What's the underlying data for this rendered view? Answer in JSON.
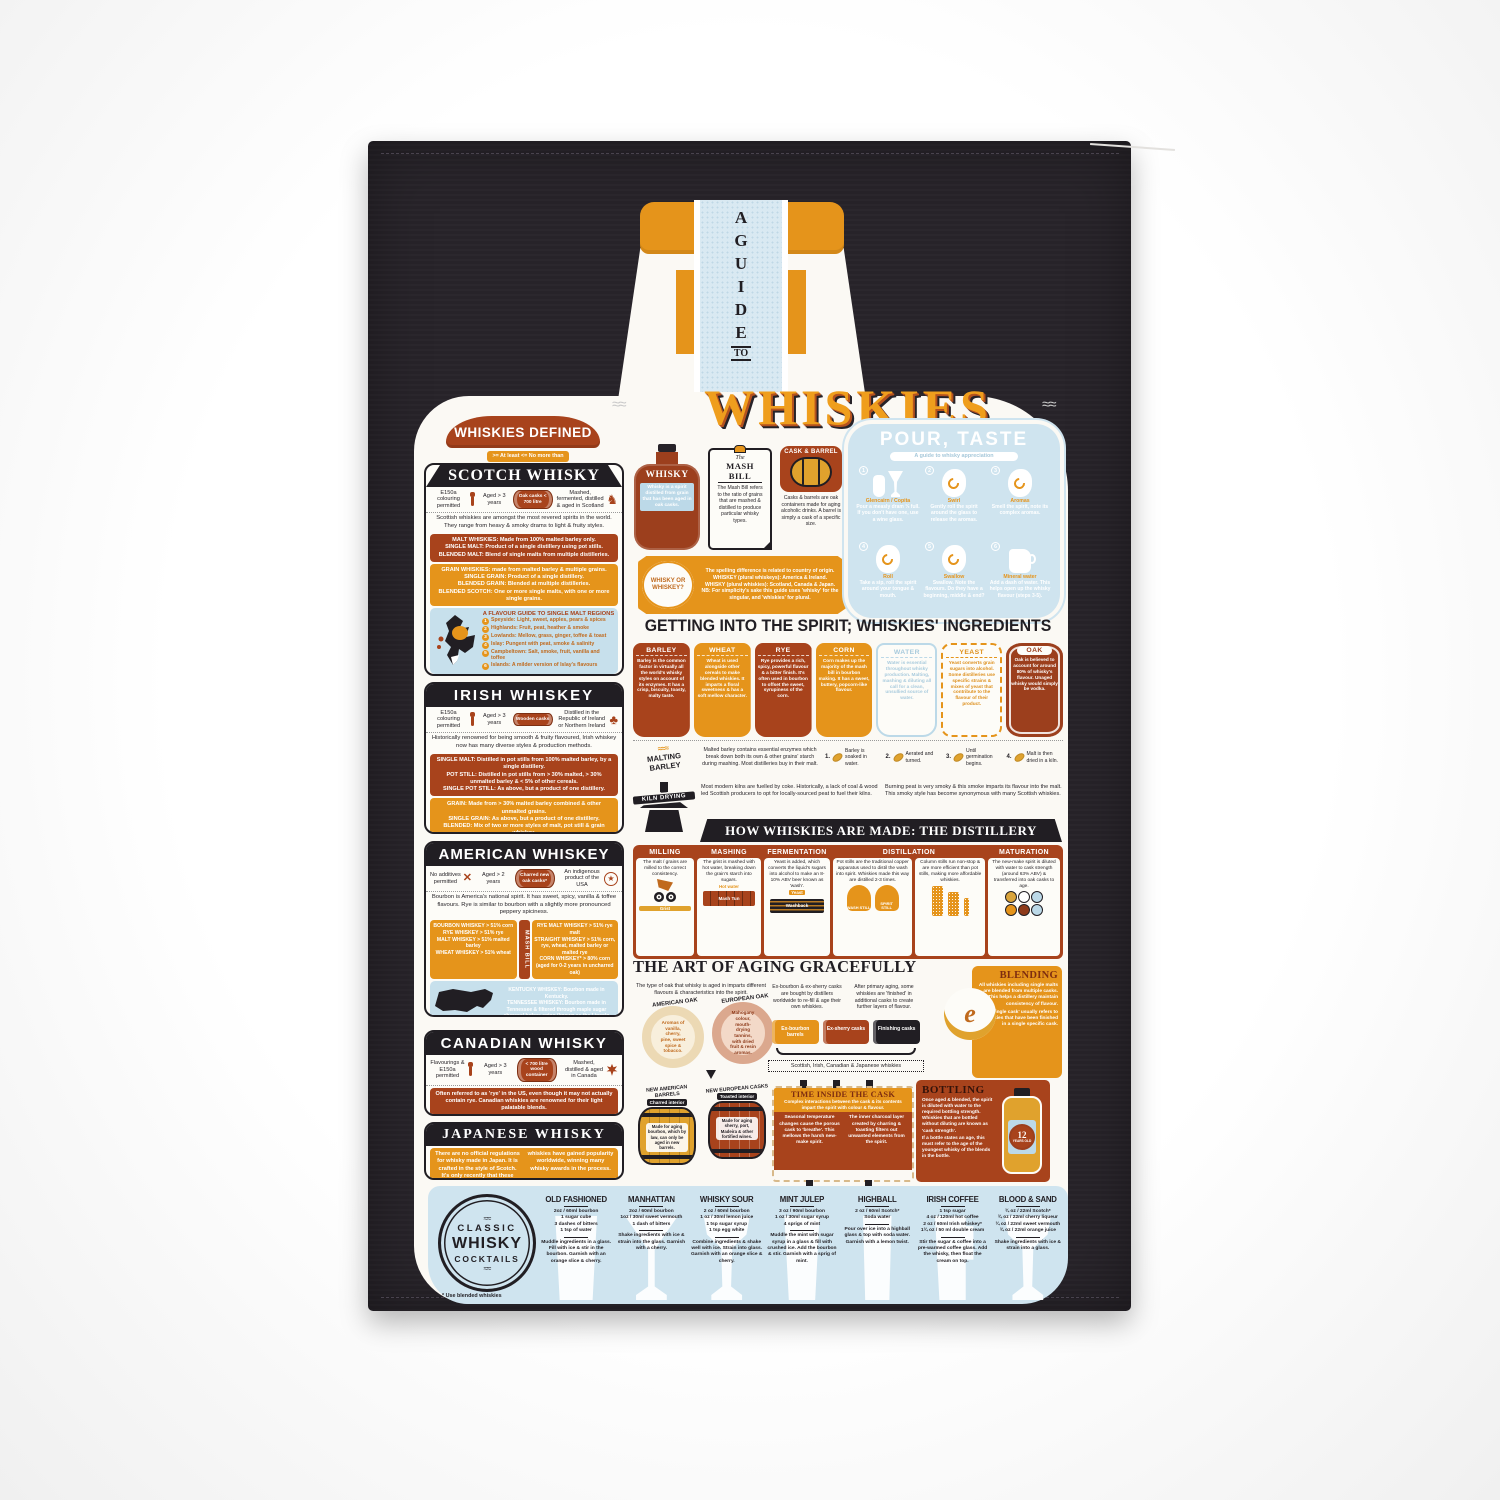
{
  "colors": {
    "accent_orange": "#e5941b",
    "accent_rust": "#a8431c",
    "panel_blue": "#cfe4ef",
    "towel_black": "#272329",
    "cream": "#fbf9f4"
  },
  "neck": {
    "word": "A GUIDE",
    "to": "TO"
  },
  "title": "WHISKIES",
  "defined": {
    "banner": "WHISKIES DEFINED",
    "key": ">= At least   <= No more than"
  },
  "scotch": {
    "title": "SCOTCH WHISKY",
    "rules": [
      "E150a colouring permitted",
      "Aged > 3 years",
      "Oak casks < 700 litre",
      "Mashed, fermented, distilled & aged in Scotland"
    ],
    "intro": "Scottish whiskies are amongst the most revered spirits in the world. They range from heavy & smoky drams to light & fruity styles.",
    "malt": "MALT WHISKIES: Made from 100% malted barley only.\nSINGLE MALT: Product of a single distillery using pot stills.\nBLENDED MALT: Blend of single malts from multiple distilleries.",
    "grain": "GRAIN WHISKIES: made from malted barley & multiple grains.\nSINGLE GRAIN: Product of a single distillery.\nBLENDED GRAIN: Blended at multiple distilleries.\nBLENDED SCOTCH: One or more single malts, with one or more single grains.",
    "regions_title": "A FLAVOUR GUIDE TO SINGLE MALT REGIONS",
    "regions": [
      {
        "n": "1",
        "t": "Speyside: Light, sweet, apples, pears & spices"
      },
      {
        "n": "2",
        "t": "Highlands: Fruit, peat, heather & smoke"
      },
      {
        "n": "3",
        "t": "Lowlands: Mellow, grass, ginger, toffee & toast"
      },
      {
        "n": "4",
        "t": "Islay: Pungent with peat, smoke & salinity"
      },
      {
        "n": "5",
        "t": "Campbeltown: Salt, smoke, fruit, vanilla and toffee"
      },
      {
        "n": "6",
        "t": "Islands: A milder version of Islay's flavours"
      }
    ]
  },
  "irish": {
    "title": "IRISH WHISKEY",
    "rules": [
      "E150a colouring permitted",
      "Aged > 3 years",
      "Wooden casks",
      "Distilled in the Republic of Ireland or Northern Ireland"
    ],
    "intro": "Historically renowned for being smooth & fruity flavoured, Irish whiskey now has many diverse styles & production methods.",
    "malt": "SINGLE MALT: Distilled in pot stills from 100% malted barley, by a single distillery.\nPOT STILL: Distilled in pot stills from > 30% malted, > 30% unmalted barley & < 5% of other cereals.\nSINGLE POT STILL: As above, but a product of one distillery.",
    "grain": "GRAIN: Made from > 30% malted barley combined & other unmalted grains.\nSINGLE GRAIN: As above, but a product of one distillery.\nBLENDED: Mix of two or more styles of malt, pot still & grain whiskey."
  },
  "american": {
    "title": "AMERICAN WHISKEY",
    "rules": [
      "No additives permitted",
      "Aged > 2 years",
      "Charred new oak casks*",
      "An indigenous product of the USA"
    ],
    "intro": "Bourbon is America's national spirit. It has sweet, spicy, vanilla & toffee flavours. Rye is similar to bourbon with a slightly more pronounced peppery spiciness.",
    "mash_label": "MASH BILL",
    "mash_left": "BOURBON WHISKEY > 51% corn\nRYE WHISKEY > 51% rye\nMALT WHISKEY > 51% malted barley\nWHEAT WHISKEY > 51% wheat",
    "mash_right": "RYE MALT WHISKEY > 51% rye malt\nSTRAIGHT WHISKEY > 51% corn, rye, wheat, malted barley or malted rye\nCORN WHISKEY* > 80% corn (aged for 0-2 years in uncharred oak)",
    "states": "KENTUCKY WHISKEY: Bourbon made in Kentucky.\nTENNESSEE WHISKEY: Bourbon made in Tennessee & filtered through maple sugar charcoal before aging (known as the Lincoln County Process)."
  },
  "canadian": {
    "title": "CANADIAN WHISKY",
    "rules": [
      "Flavourings & E150a permitted",
      "Aged > 3 years",
      "< 700 litre wood container",
      "Mashed, distilled & aged in Canada"
    ],
    "note": "Often referred to as 'rye' in the US, even though it may not actually contain rye. Canadian whiskies are renowned for their light palatable blends."
  },
  "japanese": {
    "title": "JAPANESE WHISKY",
    "note": "There are no official regulations for whisky made in Japan. It is crafted in the style of Scotch. It's only recently that these whiskies have gained popularity worldwide, winning many whisky awards in the process."
  },
  "glossary": {
    "whisky_label": "WHISKY",
    "whisky_def": "Whisky is a spirit distilled from grain that has been aged in oak casks.",
    "mash_pre": "The",
    "mash_title": "MASH BILL",
    "mash_text": "The Mash Bill refers to the ratio of grains that are mashed & distilled to produce particular whisky types.",
    "cask_title": "CASK & BARREL",
    "cask_text": "Casks & barrels are oak containers made for aging alcoholic drinks. A barrel is simply a cask of a specific size.",
    "spell_badge": "WHISKY OR WHISKEY?",
    "spell_text": "The spelling difference is related to country of origin.\nWHISKEY (plural whiskeys): America & Ireland.\nWHISKY (plural whiskies): Scotland, Canada & Japan.\nNB: For simplicity's sake this guide uses 'whisky' for the singular, and 'whiskies' for plural."
  },
  "pour": {
    "title": "POUR, TASTE",
    "subtitle": "A guide to whisky appreciation",
    "steps": [
      {
        "n": "1",
        "label": "Glencairn / Copita",
        "text": "Pour a measly dram ⅓ full. If you don't have one, use a wine glass."
      },
      {
        "n": "2",
        "label": "Swirl",
        "text": "Gently roll the spirit around the glass to release the aromas."
      },
      {
        "n": "3",
        "label": "Aromas",
        "text": "Smell the spirit, note its complex aromas."
      },
      {
        "n": "4",
        "label": "Roll",
        "text": "Take a sip, roll the spirit around your tongue & mouth."
      },
      {
        "n": "5",
        "label": "Swallow",
        "text": "Swallow. Note the flavours. Do they have a beginning, middle & end?"
      },
      {
        "n": "6",
        "label": "Mineral water",
        "text": "Add a dash of water. This helps open up the whisky flavour (steps 3-5)."
      }
    ]
  },
  "ingredients": {
    "title": "GETTING INTO THE SPIRIT; WHISKIES' INGREDIENTS",
    "items": [
      {
        "name": "BARLEY",
        "text": "Barley is the common factor in virtually all the world's whisky styles on account of its enzymes. It has a crisp, biscuity, toasty, malty taste."
      },
      {
        "name": "WHEAT",
        "text": "Wheat is used alongside other cereals to make blended whiskies. It imparts a floral sweetness & has a soft mellow character."
      },
      {
        "name": "RYE",
        "text": "Rye provides a rich, spicy, powerful flavour & a bitter finish. It's often used in bourbon to offset the sweet, syrupiness of the corn."
      },
      {
        "name": "CORN",
        "text": "Corn makes up the majority of the mash bill in bourbon making. It has a sweet, buttery, popcorn-like flavour."
      },
      {
        "name": "WATER",
        "text": "Water is essential throughout whisky production. Malting, mashing & diluting all call for a clean, unsullied source of water."
      },
      {
        "name": "YEAST",
        "text": "Yeast converts grain sugars into alcohol. Some distilleries use specific strains & mixes of yeast that contribute to the flavour of their product."
      },
      {
        "name": "OAK",
        "text": "Oak is believed to account for around 80% of whisky's flavour. Unaged whisky would simply be vodka."
      }
    ]
  },
  "malting": {
    "label": "MALTING BARLEY",
    "text": "Malted barley contains essential enzymes which break down both its own & other grains' starch during mashing. Most distilleries buy in their malt.",
    "steps": [
      {
        "n": "1.",
        "t": "Barley is soaked in water."
      },
      {
        "n": "2.",
        "t": "Aerated and turned."
      },
      {
        "n": "3.",
        "t": "Until germination begins."
      },
      {
        "n": "4.",
        "t": "Malt is then dried in a kiln."
      }
    ]
  },
  "kiln": {
    "label": "KILN DRYING",
    "text1": "Most modern kilns are fuelled by coke. Historically, a lack of coal & wood led Scottish producers to opt for locally-sourced peat to fuel their kilns.",
    "text2": "Burning peat is very smoky & this smoke imparts its flavour into the malt. This smoky style has become synonymous with many Scottish whiskies."
  },
  "distillery": {
    "title": "HOW WHISKIES ARE MADE: THE DISTILLERY",
    "milling": {
      "name": "MILLING",
      "text": "The malt / grains are milled to the correct consistency.",
      "icon": "Grist"
    },
    "mashing": {
      "name": "MASHING",
      "text": "The grist is mashed with hot water, breaking down the grain's starch into sugars.",
      "tap": "Hot water",
      "icon": "Mash Tun"
    },
    "fermentation": {
      "name": "FERMENTATION",
      "text": "Yeast is added, which converts the liquid's sugars into alcohol to make an 8-10% ABV beer known as 'wash'.",
      "yeast": "Yeast",
      "icon": "Washback"
    },
    "distillation": {
      "name": "DISTILLATION",
      "text_pot": "Pot stills are the traditional copper apparatus used to distil the wash into spirit. Whiskies made this way are distilled 2-3 times.",
      "still1": "WASH STILL",
      "still2": "SPIRIT STILL",
      "text_col": "Column stills run non-stop & are more efficient than pot stills, making more affordable whiskies."
    },
    "maturation": {
      "name": "MATURATION",
      "text": "The new-make spirit is diluted with water to cask strength (around 63% ABV) & transferred into oak casks to age."
    }
  },
  "aging": {
    "title": "THE ART OF AGING GRACEFULLY",
    "intro": "The type of oak that whisky is aged in imparts different flavours & characteristics into the spirit.",
    "american_label": "AMERICAN OAK",
    "american_text": "Aromas of vanilla, cherry, pine, sweet spice & tobacco.",
    "european_label": "EUROPEAN OAK",
    "european_text": "Mahogany colour, mouth-drying tannins, with dried fruit & resin aromas.",
    "refill": "Ex-bourbon & ex-sherry casks are bought by distillers worldwide to re-fill & age their own whiskies.",
    "finishing": "After primary aging, some whiskies are 'finished' in additional casks to create further layers of flavour.",
    "cask1": "Ex-bourbon barrels",
    "cask2": "Ex-sherry casks",
    "cask3": "Finishing casks",
    "brace": "Scottish, Irish, Canadian & Japanese whiskies",
    "barrel1": {
      "title": "NEW AMERICAN BARRELS",
      "sub": "Charred interior",
      "text": "Made for aging bourbon, which by law, can only be aged in new barrels."
    },
    "barrel2": {
      "title": "NEW EUROPEAN CASKS",
      "sub": "Toasted interior",
      "text": "Made for aging sherry, port, Madeira & other fortified wines."
    }
  },
  "blending": {
    "title": "BLENDING",
    "text1": "All whiskies including single malts are blended from multiple casks. This helps a distillery maintain consistency of flavour.",
    "text2": "'Single cask' usually refers to whiskies that have been finished in a single specific cask."
  },
  "cask_time": {
    "title": "TIME INSIDE THE CASK",
    "intro": "Complex interactions between the cask & its contents impart the spirit with colour & flavour.",
    "left": "Seasonal temperature changes cause the porous cask to 'breathe'. This mellows the harsh new-make spirit.",
    "right": "The inner charcoal layer created by charring & toasting filters out unwanted elements from the spirit."
  },
  "bottling": {
    "title": "BOTTLING",
    "text1": "Once aged & blended, the spirit is diluted with water to the required bottling strength. Whiskies that are bottled without diluting are known as 'cask strength'.",
    "text2": "If a bottle states an age, this must refer to the age of the youngest whisky of the blends in the bottle.",
    "label_num": "12",
    "label_sub": "YEARS OLD"
  },
  "cocktails": {
    "roundel_top": "CLASSIC",
    "roundel_mid": "WHISKY",
    "roundel_bottom": "COCKTAILS",
    "note": "* Use blended whiskies",
    "items": [
      {
        "name": "OLD FASHIONED",
        "ing": "2oz / 60ml bourbon\n1 sugar cube\n3 dashes of bitters\n1 tsp of water",
        "met": "Muddle ingredients in a glass. Fill with ice & stir in the bourbon. Garnish with an orange slice & cherry."
      },
      {
        "name": "MANHATTAN",
        "ing": "2oz / 60ml bourbon\n1oz / 30ml sweet vermouth\n1 dash of bitters",
        "met": "Shake ingredients with ice & strain into the glass. Garnish with a cherry."
      },
      {
        "name": "WHISKY SOUR",
        "ing": "2 oz / 60ml bourbon\n1 oz / 30ml lemon juice\n1 tsp sugar syrup\n1 tsp egg white",
        "met": "Combine ingredients & shake well with ice. Strain into glass. Garnish with an orange slice & cherry."
      },
      {
        "name": "MINT JULEP",
        "ing": "3 oz / 90ml bourbon\n1 oz / 30ml sugar syrup\n4 sprigs of mint",
        "met": "Muddle the mint with sugar syrup in a glass & fill with crushed ice. Add the bourbon & stir. Garnish with a sprig of mint."
      },
      {
        "name": "HIGHBALL",
        "ing": "2 oz / 60ml Scotch*\nSoda water",
        "met": "Pour over ice into a highball glass & top with soda water. Garnish with a lemon twist."
      },
      {
        "name": "IRISH COFFEE",
        "ing": "1 tsp sugar\n4 oz / 120ml hot coffee\n2 oz / 60ml Irish whiskey*\n1¾ oz / 50 ml double cream",
        "met": "Stir the sugar & coffee into a pre-warmed coffee glass. Add the whisky, then float the cream on top."
      },
      {
        "name": "BLOOD & SAND",
        "ing": "¾ oz / 22ml Scotch*\n¾ oz / 22ml cherry liqueur\n¾ oz / 22ml sweet vermouth\n¾ oz / 22ml orange juice",
        "met": "Shake ingredients with ice & strain into a glass."
      }
    ]
  }
}
